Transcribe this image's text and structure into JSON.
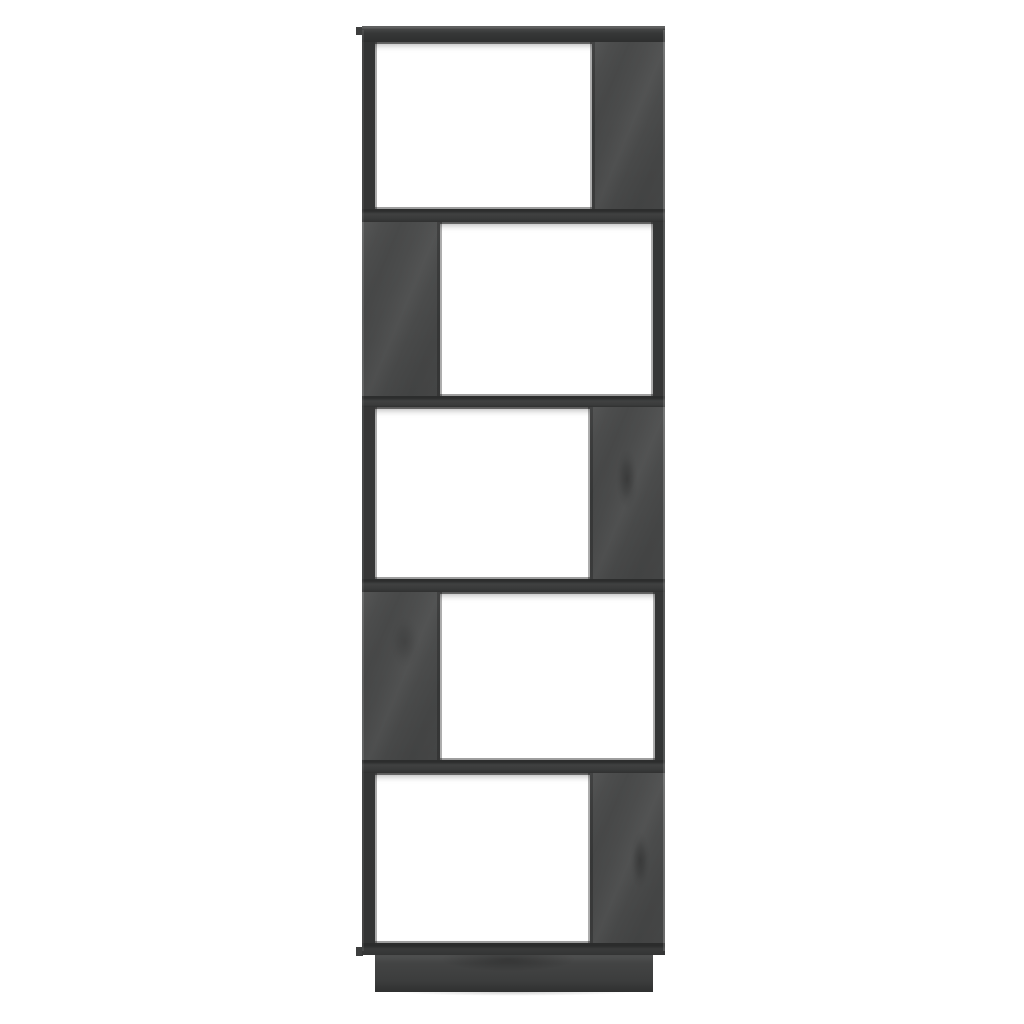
{
  "image": {
    "type": "product-photo",
    "subject": "Five-tier zigzag book cabinet / room divider in gray pinewood",
    "view": "front",
    "background_color": "#ffffff"
  },
  "colors": {
    "background": "#ffffff",
    "panel": "#4a4b4b",
    "frame": "#333434",
    "divider": "#3a3b3b",
    "board_top": "#373838",
    "edge_highlight": "#5f6060",
    "base": "#434444",
    "opening": "#ffffff"
  },
  "shelf": {
    "tier_count": 5,
    "tiers": [
      {
        "name": "tier-1",
        "opening_side": "left",
        "panel_side": "right",
        "knot": false
      },
      {
        "name": "tier-2",
        "opening_side": "right",
        "panel_side": "left",
        "knot": false
      },
      {
        "name": "tier-3",
        "opening_side": "left",
        "panel_side": "right",
        "knot": true
      },
      {
        "name": "tier-4",
        "opening_side": "right",
        "panel_side": "left",
        "knot": true
      },
      {
        "name": "tier-5",
        "opening_side": "left",
        "panel_side": "right",
        "knot": true
      }
    ],
    "has_base": true,
    "material_texture": "pine wood grain with knots"
  }
}
